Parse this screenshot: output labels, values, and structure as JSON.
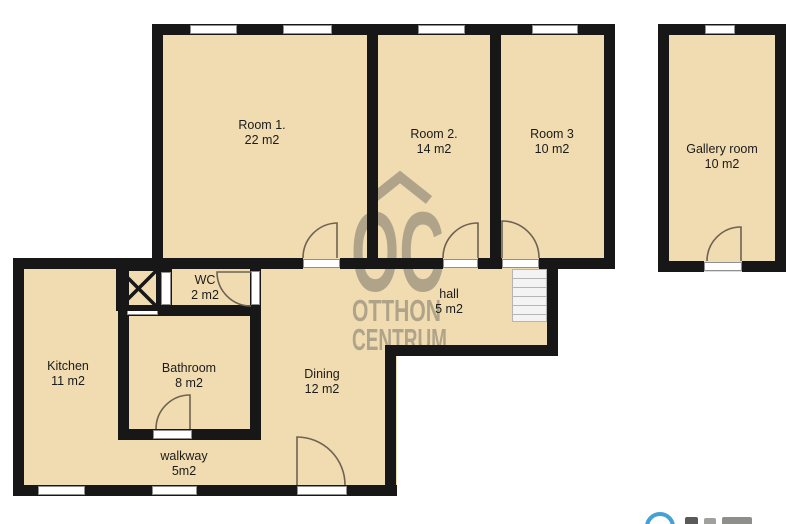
{
  "rooms": [
    {
      "id": "room1",
      "name": "Room 1.",
      "area": "22 m2"
    },
    {
      "id": "room2",
      "name": "Room 2.",
      "area": "14 m2"
    },
    {
      "id": "room3",
      "name": "Room 3",
      "area": "10 m2"
    },
    {
      "id": "gallery",
      "name": "Gallery room",
      "area": "10 m2"
    },
    {
      "id": "wc",
      "name": "WC",
      "area": "2 m2"
    },
    {
      "id": "hall",
      "name": "hall",
      "area": "5 m2"
    },
    {
      "id": "kitchen",
      "name": "Kitchen",
      "area": "11 m2"
    },
    {
      "id": "bathroom",
      "name": "Bathroom",
      "area": "8 m2"
    },
    {
      "id": "dining",
      "name": "Dining",
      "area": "12 m2"
    },
    {
      "id": "walkway",
      "name": "walkway",
      "area": "5m2"
    }
  ],
  "watermark": {
    "monogram": "OC",
    "line1": "OTTHON",
    "line2": "CENTRUM",
    "color": "#6f6b62"
  },
  "colors": {
    "floor": "#f1dcb1",
    "wall": "#171717",
    "door_swing": "#6e6352",
    "window_frame": "#8f8f8f",
    "partner_logo_blue": "#45a1d5",
    "background": "#ffffff"
  }
}
